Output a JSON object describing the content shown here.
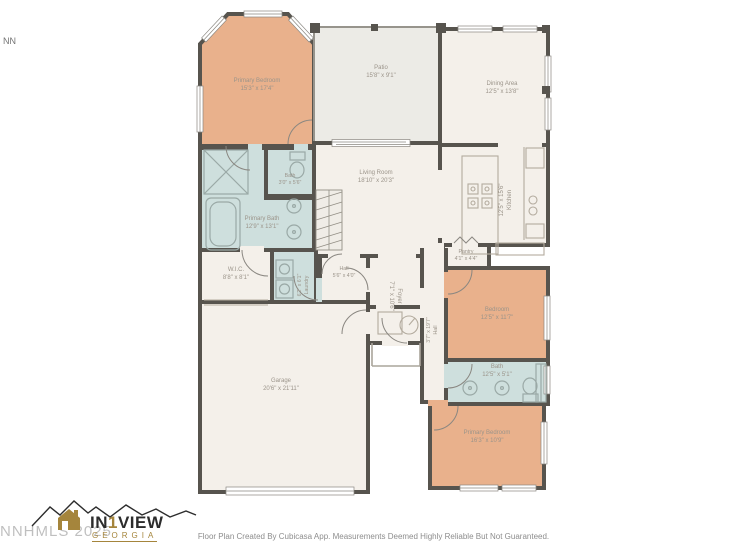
{
  "watermark": {
    "main": "NNHMLS 2025",
    "corner": "NN"
  },
  "logo": {
    "pre": "IN",
    "one": "1",
    "post": "VIEW",
    "region": "GEORGIA"
  },
  "footer": {
    "disclaimer": "Floor Plan Created By Cubicasa App. Measurements Deemed Highly Reliable But Not Guaranteed."
  },
  "colors": {
    "bedroom_fill": "#e9b18c",
    "bath_fill": "#cedfdd",
    "room_fill": "#f4f0ea",
    "patio_fill": "#ecebe6",
    "wall": "#57544e",
    "label_text": "#9b948a",
    "logo_gold": "#a5853c"
  },
  "rooms": [
    {
      "name": "Primary Bedroom",
      "dims": "15'3\" x 17'4\""
    },
    {
      "name": "Patio",
      "dims": "15'8\" x 9'1\""
    },
    {
      "name": "Dining Area",
      "dims": "12'5\" x 13'8\""
    },
    {
      "name": "Living Room",
      "dims": "18'10\" x 20'3\""
    },
    {
      "name": "Kitchen",
      "dims": "12'5\" x 15'6\""
    },
    {
      "name": "Pantry",
      "dims": "4'1\" x 4'4\""
    },
    {
      "name": "Bath",
      "dims": "3'0\" x 5'6\""
    },
    {
      "name": "Primary Bath",
      "dims": "12'9\" x 13'1\""
    },
    {
      "name": "W.I.C.",
      "dims": "8'8\" x 8'1\""
    },
    {
      "name": "Laundry",
      "dims": "6'2\" x 6'1\""
    },
    {
      "name": "Hall",
      "dims": "5'6\" x 4'0\""
    },
    {
      "name": "Foyer",
      "dims": "7'1\" x 10'6\""
    },
    {
      "name": "Hall",
      "dims": "3'7\" x 19'7\""
    },
    {
      "name": "Bedroom",
      "dims": "12'5\" x 11'7\""
    },
    {
      "name": "Bath",
      "dims": "12'5\" x 5'1\""
    },
    {
      "name": "Primary Bedroom",
      "dims": "16'3\" x 10'9\""
    },
    {
      "name": "Garage",
      "dims": "20'6\" x 21'11\""
    }
  ]
}
